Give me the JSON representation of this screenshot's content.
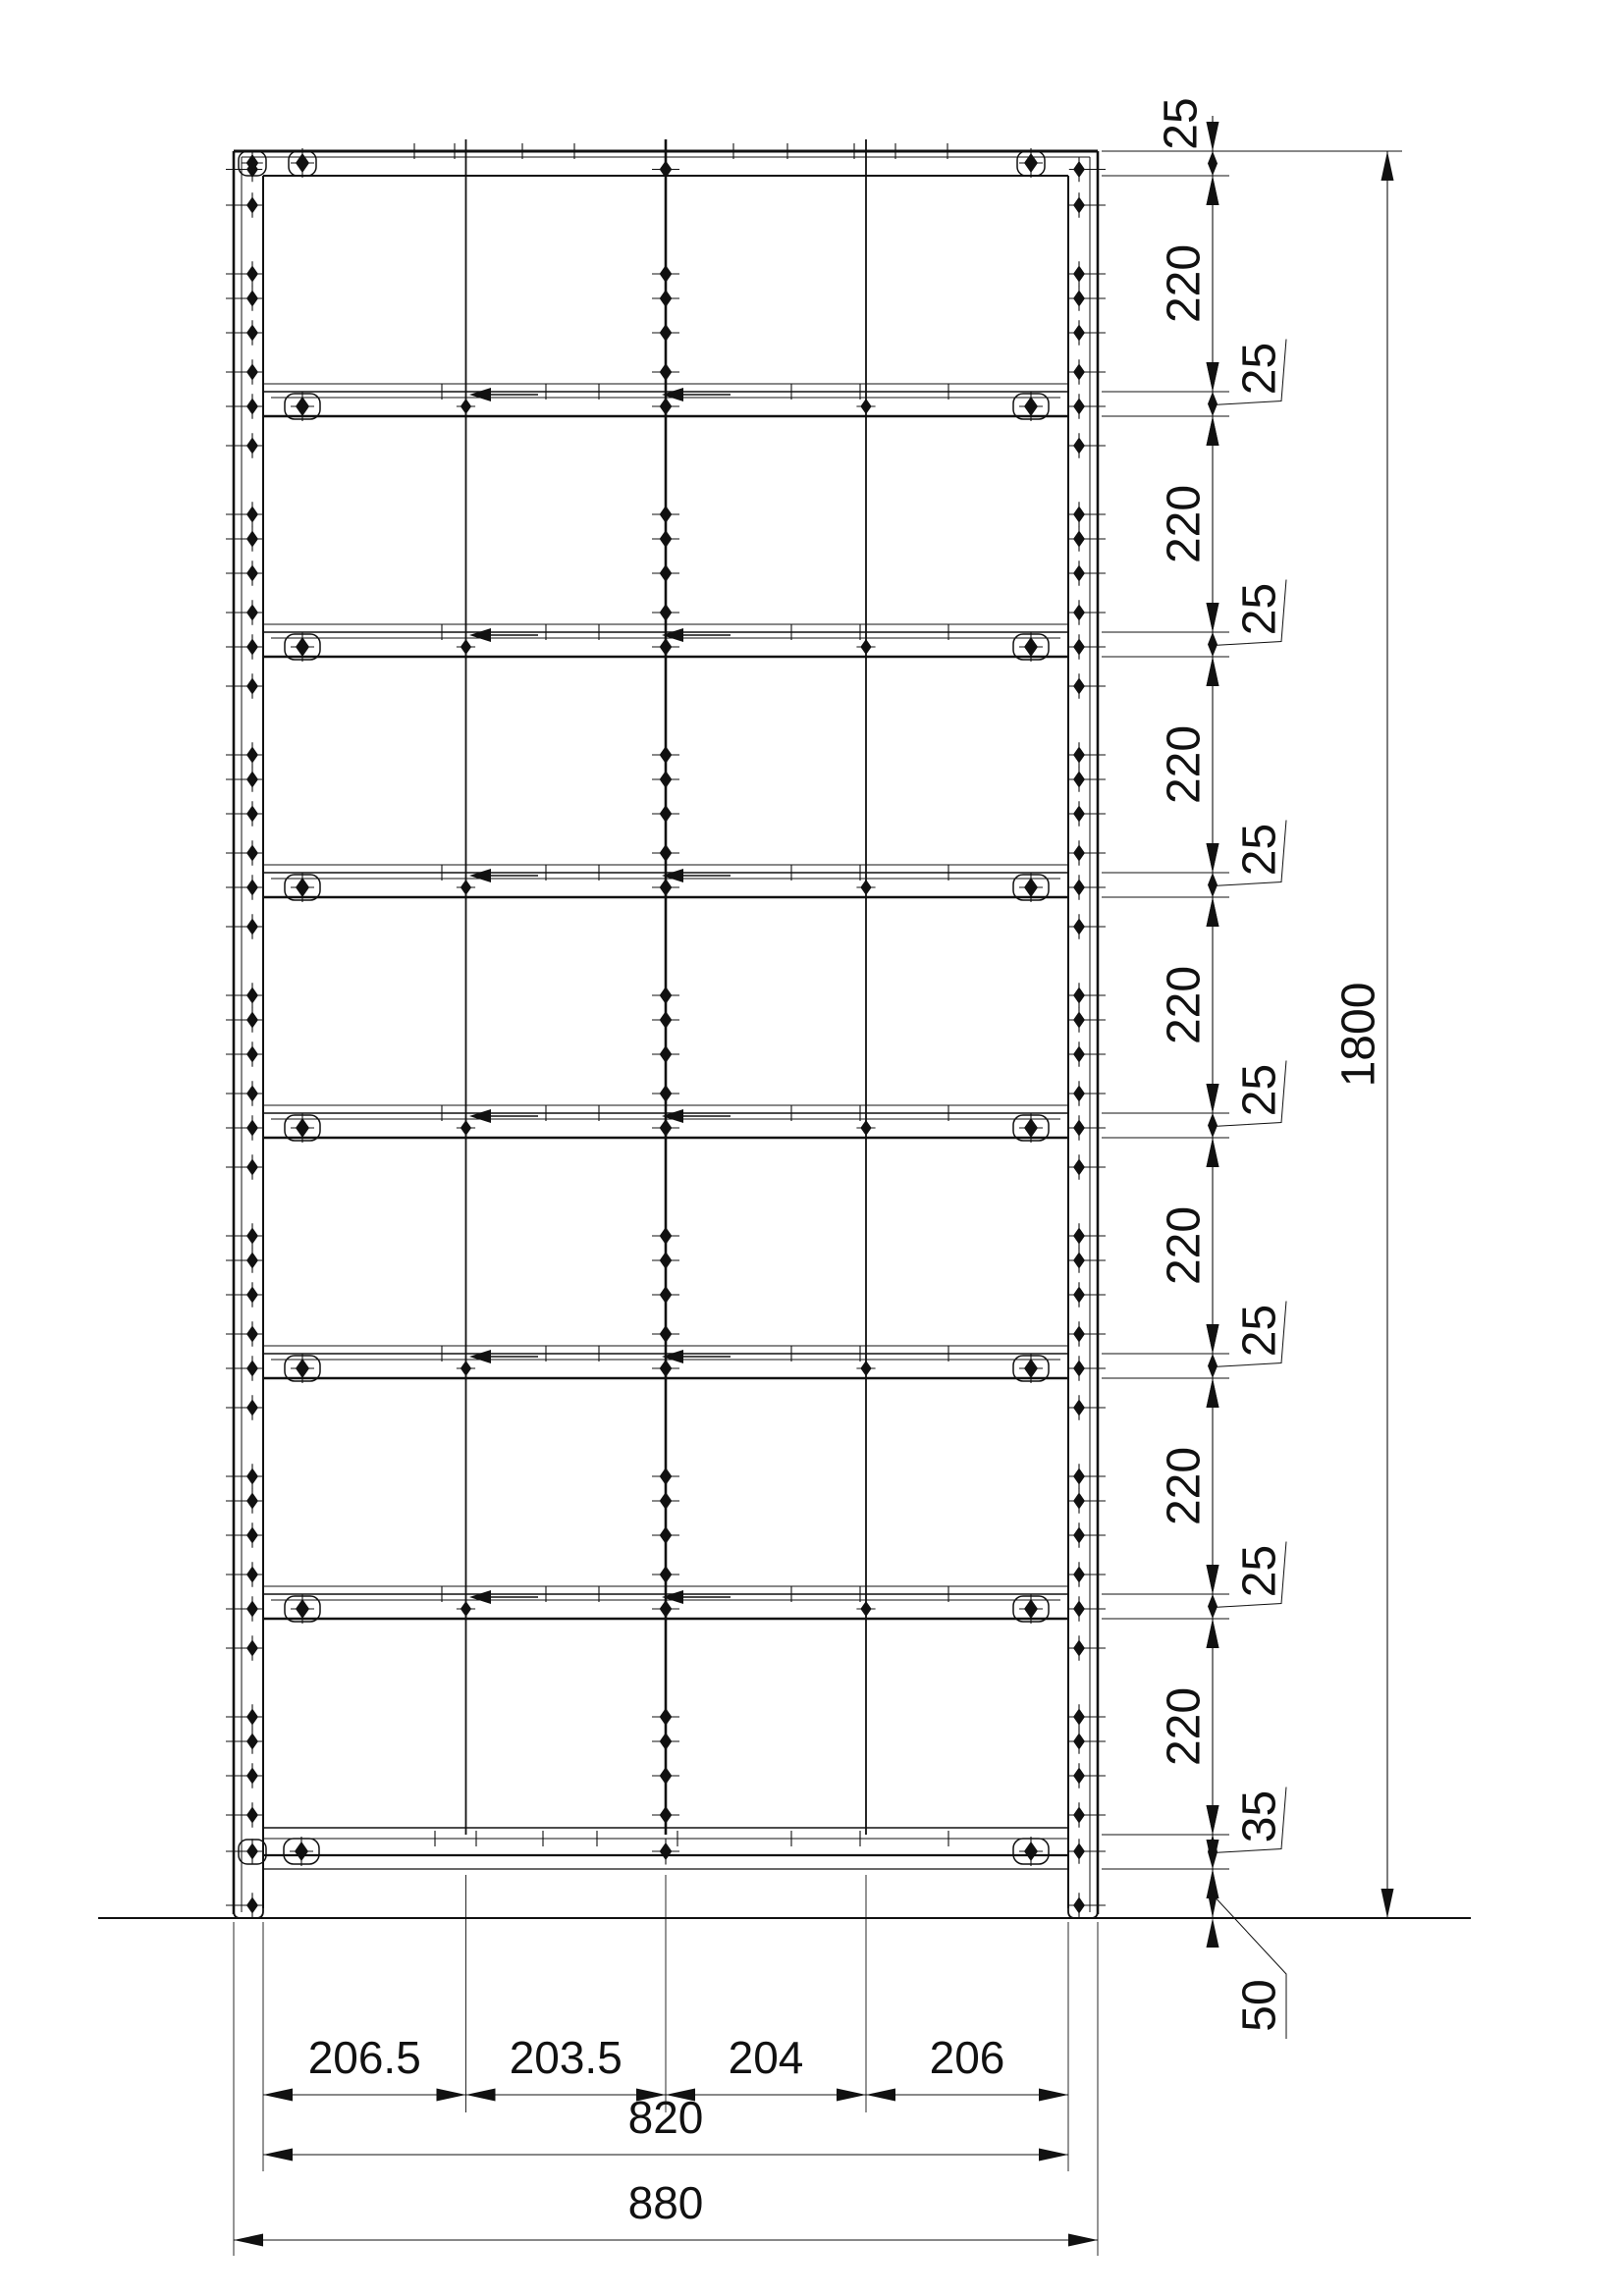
{
  "colors": {
    "line": "#111111",
    "background": "#ffffff"
  },
  "symbols": {
    "fastener": "four-point-diamond-with-cross-ticks",
    "dimension_arrow": "filled-triangle",
    "connector": "small-solid-triangle-with-tail"
  },
  "structure": {
    "bays": 7,
    "shelves": 6,
    "columns_per_shelf": 4
  },
  "dimensions": {
    "vertical_chain": [
      {
        "label": "25",
        "mm": 25
      },
      {
        "label": "220",
        "mm": 220
      },
      {
        "label": "25",
        "mm": 25
      },
      {
        "label": "220",
        "mm": 220
      },
      {
        "label": "25",
        "mm": 25
      },
      {
        "label": "220",
        "mm": 220
      },
      {
        "label": "25",
        "mm": 25
      },
      {
        "label": "220",
        "mm": 220
      },
      {
        "label": "25",
        "mm": 25
      },
      {
        "label": "220",
        "mm": 220
      },
      {
        "label": "25",
        "mm": 25
      },
      {
        "label": "220",
        "mm": 220
      },
      {
        "label": "25",
        "mm": 25
      },
      {
        "label": "220",
        "mm": 220
      },
      {
        "label": "35",
        "mm": 35
      },
      {
        "label": "50",
        "mm": 50
      }
    ],
    "overall_height": {
      "label": "1800",
      "mm": 1800
    },
    "column_widths": [
      {
        "label": "206.5",
        "mm": 206.5
      },
      {
        "label": "203.5",
        "mm": 203.5
      },
      {
        "label": "204",
        "mm": 204
      },
      {
        "label": "206",
        "mm": 206
      }
    ],
    "inner_width": {
      "label": "820",
      "mm": 820
    },
    "outer_width": {
      "label": "880",
      "mm": 880
    },
    "side_panel_thickness_mm": 30
  }
}
